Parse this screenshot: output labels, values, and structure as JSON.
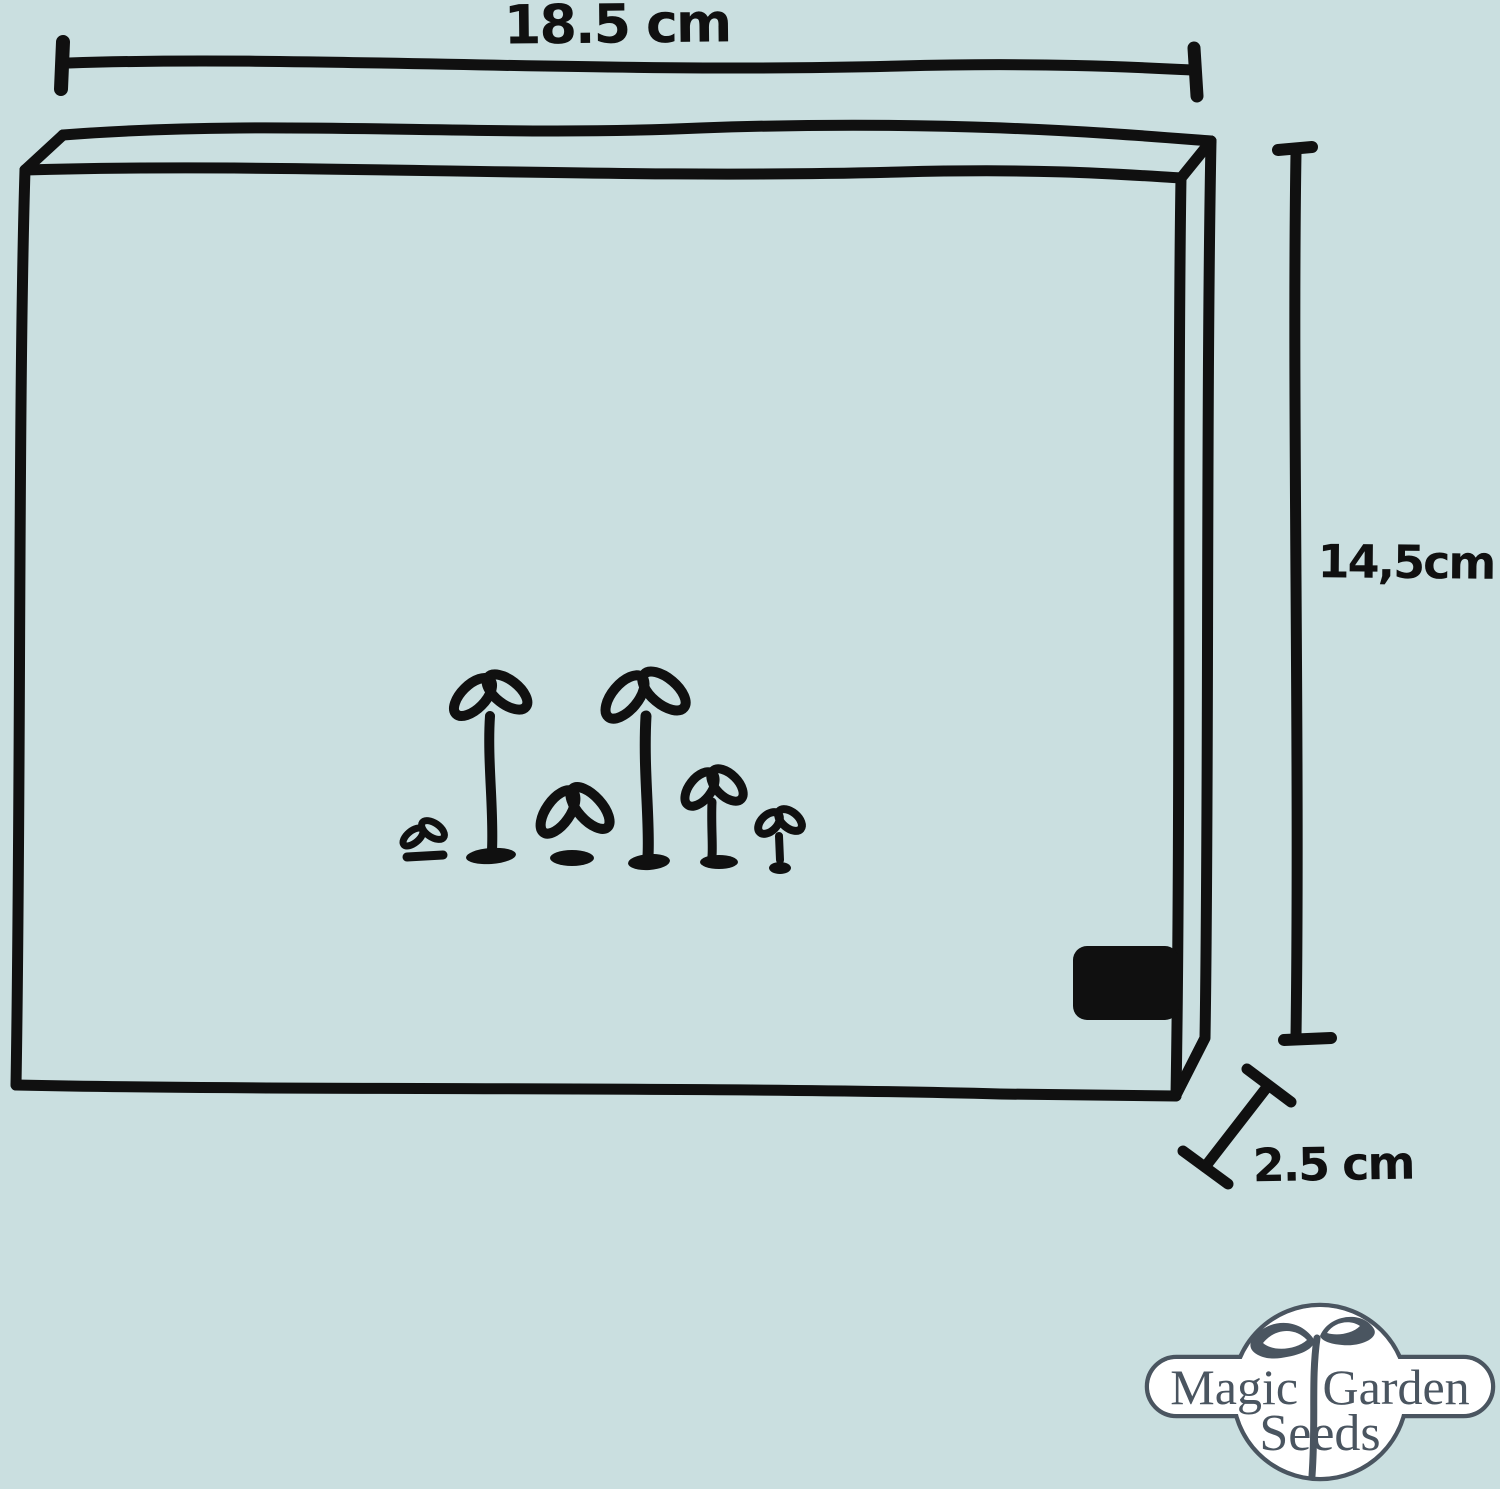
{
  "diagram": {
    "type": "product-dimension-sketch",
    "subject": "seed box with sprouting seedlings",
    "dimensions": {
      "width": {
        "label": "18.5 cm",
        "value": 18.5,
        "unit": "cm",
        "orientation": "horizontal-top"
      },
      "height": {
        "label": "14,5cm",
        "value": 14.5,
        "unit": "cm",
        "orientation": "vertical-right"
      },
      "depth": {
        "label": "2.5 cm",
        "value": 2.5,
        "unit": "cm",
        "orientation": "diagonal-bottom-right"
      }
    },
    "sprout_count": 6,
    "features": [
      "hand-drawn 3d box",
      "black clasp on right side",
      "six seedlings inside box"
    ]
  },
  "logo": {
    "line1": "Magic Garden",
    "line2": "Seeds"
  },
  "colors": {
    "background": "#cadfe0",
    "ink": "#101010",
    "logo_ink": "#4a5560",
    "logo_background": "#ffffff"
  }
}
